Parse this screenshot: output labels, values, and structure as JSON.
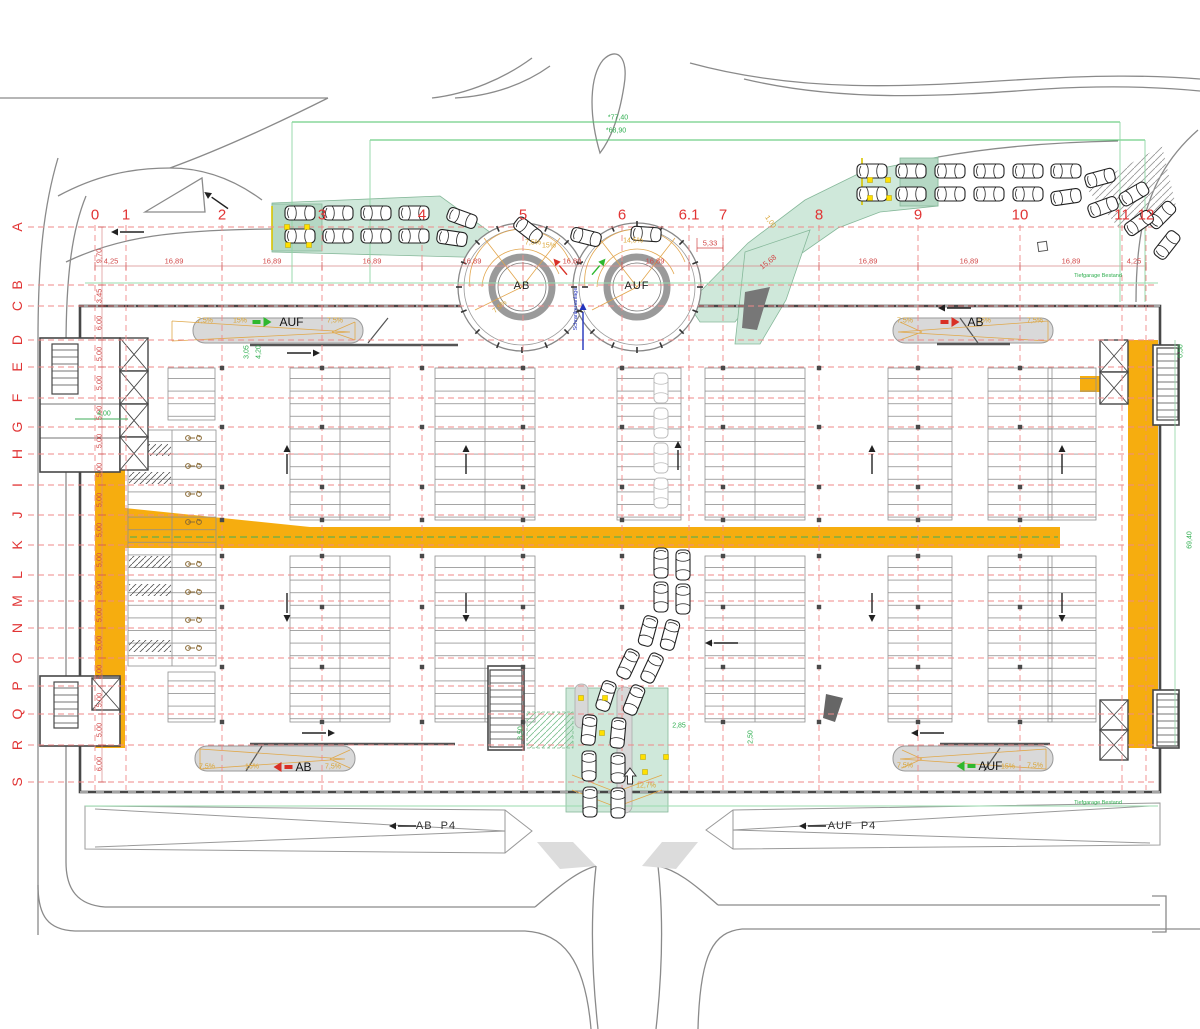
{
  "drawing": {
    "type": "parking-garage-floor-plan",
    "circle_ramp_left": "AB",
    "circle_ramp_right": "AUF"
  },
  "colors": {
    "grid_red": "#e13535",
    "dim_green": "#2fae4f",
    "lane_orange": "#F6AD0F",
    "ramp_green_fill": "#cfe8da",
    "slope_orange": "#d9a434",
    "note_blue": "#2233bb"
  },
  "grid": {
    "columns": [
      [
        "0",
        95
      ],
      [
        "1",
        126
      ],
      [
        "2",
        222
      ],
      [
        "3",
        322
      ],
      [
        "4",
        422
      ],
      [
        "5",
        523
      ],
      [
        "6",
        622
      ],
      [
        "6.1",
        689
      ],
      [
        "7",
        723
      ],
      [
        "8",
        819
      ],
      [
        "9",
        918
      ],
      [
        "10",
        1020
      ],
      [
        "11",
        1122
      ],
      [
        "12",
        1146
      ]
    ],
    "rows": [
      [
        "A",
        227
      ],
      [
        "B",
        285
      ],
      [
        "C",
        306
      ],
      [
        "D",
        340
      ],
      [
        "E",
        367
      ],
      [
        "F",
        398
      ],
      [
        "G",
        427
      ],
      [
        "H",
        454
      ],
      [
        "I",
        485
      ],
      [
        "J",
        515
      ],
      [
        "K",
        545
      ],
      [
        "L",
        575
      ],
      [
        "M",
        601
      ],
      [
        "N",
        628
      ],
      [
        "O",
        658
      ],
      [
        "P",
        686
      ],
      [
        "Q",
        714
      ],
      [
        "R",
        745
      ],
      [
        "S",
        782
      ]
    ],
    "row_dims": [
      "9,70",
      "3,45",
      "6,00",
      "5,00",
      "5,00",
      "5,00",
      "5,00",
      "5,00",
      "5,00",
      "5,00",
      "5,00",
      "3,90",
      "5,00",
      "5,00",
      "5,00",
      "5,00",
      "5,00",
      "6,00"
    ]
  },
  "texts": [
    [
      "*77,40",
      618,
      118,
      "dg",
      0
    ],
    [
      "*68,90",
      616,
      131,
      "dg",
      0
    ],
    [
      "4,25",
      111,
      261,
      "dr",
      0
    ],
    [
      "16,89",
      174,
      261,
      "dr",
      0
    ],
    [
      "16,89",
      272,
      261,
      "dr",
      0
    ],
    [
      "16,89",
      372,
      261,
      "dr",
      0
    ],
    [
      "16,89",
      472,
      261,
      "dr",
      0
    ],
    [
      "16,89",
      572,
      261,
      "dr",
      0
    ],
    [
      "16,89",
      655,
      261,
      "dr",
      0
    ],
    [
      "5,33",
      710,
      243,
      "dr",
      0
    ],
    [
      "15,68",
      768,
      262,
      "dr",
      -38
    ],
    [
      "16,89",
      868,
      261,
      "dr",
      0
    ],
    [
      "16,89",
      969,
      261,
      "dr",
      0
    ],
    [
      "16,89",
      1071,
      261,
      "dr",
      0
    ],
    [
      "4,25",
      1134,
      261,
      "dr",
      0
    ],
    [
      "4,00",
      104,
      414,
      "dg",
      0
    ],
    [
      "3,05",
      247,
      352,
      "dg",
      -90
    ],
    [
      "4,20",
      259,
      352,
      "dg",
      -90
    ],
    [
      "0,50",
      1181,
      351,
      "dg",
      -90
    ],
    [
      "69,40",
      1190,
      540,
      "dg",
      -90
    ],
    [
      "2,85",
      679,
      726,
      "dg",
      0
    ],
    [
      "2,50",
      751,
      737,
      "dg",
      -90
    ],
    [
      "3,50",
      521,
      733,
      "dg",
      -90
    ],
    [
      "7,5%",
      205,
      321,
      "pc",
      0
    ],
    [
      "15%",
      240,
      321,
      "pc",
      0
    ],
    [
      "7,5%",
      335,
      321,
      "pc",
      0
    ],
    [
      "7,5%",
      905,
      321,
      "pc",
      0
    ],
    [
      "15%",
      984,
      321,
      "pc",
      0
    ],
    [
      "7,5%",
      1035,
      321,
      "pc",
      0
    ],
    [
      "7,5%",
      207,
      767,
      "pc",
      0
    ],
    [
      "15%",
      252,
      767,
      "pc",
      0
    ],
    [
      "7,5%",
      333,
      767,
      "pc",
      0
    ],
    [
      "7,5%",
      905,
      766,
      "pc",
      0
    ],
    [
      "15%",
      1008,
      767,
      "pc",
      0
    ],
    [
      "7,5%",
      1035,
      766,
      "pc",
      0
    ],
    [
      "14,5%",
      633,
      241,
      "pc",
      0
    ],
    [
      "15%",
      549,
      246,
      "pc",
      0
    ],
    [
      "7,5%",
      533,
      243,
      "pc",
      0
    ],
    [
      "7,5%",
      500,
      307,
      "pc",
      -40
    ],
    [
      "12,7%",
      646,
      786,
      "pc",
      0
    ],
    [
      "1,00",
      770,
      222,
      "pc",
      55
    ],
    [
      "AB",
      522,
      286,
      "cl",
      0
    ],
    [
      "AUF",
      637,
      286,
      "cl",
      0
    ],
    [
      "AB  P4",
      436,
      826,
      "pl",
      0
    ],
    [
      "AUF  P4",
      852,
      826,
      "pl",
      0
    ],
    [
      "Tiefgarage Bestand",
      1098,
      276,
      "nt",
      0
    ],
    [
      "Tiefgarage Bestand",
      1098,
      803,
      "nt",
      0
    ],
    [
      "Schrankenanlage",
      576,
      309,
      "bl",
      -90
    ]
  ],
  "ramp_labels": [
    [
      "AUF",
      278,
      322,
      "right",
      "#2eb82e"
    ],
    [
      "AB",
      962,
      322,
      "right",
      "#d93025"
    ],
    [
      "AB",
      290,
      767,
      "left",
      "#d93025"
    ],
    [
      "AUF",
      977,
      766,
      "left",
      "#2eb82e"
    ]
  ],
  "parking_banks": [
    [
      168,
      368,
      47,
      52
    ],
    [
      290,
      368,
      100,
      152
    ],
    [
      435,
      368,
      100,
      152
    ],
    [
      617,
      368,
      64,
      152
    ],
    [
      705,
      368,
      100,
      152
    ],
    [
      888,
      368,
      64,
      152
    ],
    [
      988,
      368,
      64,
      152
    ],
    [
      1048,
      368,
      48,
      152
    ],
    [
      290,
      556,
      100,
      166
    ],
    [
      435,
      556,
      100,
      166
    ],
    [
      705,
      556,
      100,
      166
    ],
    [
      888,
      556,
      64,
      166
    ],
    [
      988,
      556,
      64,
      166
    ],
    [
      1048,
      556,
      48,
      166
    ],
    [
      168,
      672,
      47,
      50
    ]
  ],
  "moto_bay": {
    "x": 128,
    "y": 430,
    "w": 88,
    "h": 236,
    "hatch_cells": [
      [
        129,
        444
      ],
      [
        129,
        472
      ],
      [
        129,
        556
      ],
      [
        129,
        584
      ],
      [
        129,
        640
      ]
    ],
    "scooters": [
      [
        193,
        438
      ],
      [
        193,
        466
      ],
      [
        193,
        494
      ],
      [
        193,
        522
      ],
      [
        193,
        564
      ],
      [
        193,
        592
      ],
      [
        193,
        620
      ],
      [
        193,
        648
      ]
    ]
  },
  "vehicles": [
    [
      300,
      213,
      0,
      0
    ],
    [
      338,
      213,
      0,
      0
    ],
    [
      376,
      213,
      0,
      0
    ],
    [
      414,
      213,
      0,
      0
    ],
    [
      462,
      218,
      20,
      0
    ],
    [
      300,
      236,
      0,
      0
    ],
    [
      338,
      236,
      0,
      0
    ],
    [
      376,
      236,
      0,
      0
    ],
    [
      414,
      236,
      0,
      0
    ],
    [
      452,
      238,
      8,
      0
    ],
    [
      528,
      230,
      38,
      0
    ],
    [
      586,
      237,
      14,
      0
    ],
    [
      646,
      234,
      4,
      0
    ],
    [
      872,
      171,
      0,
      0
    ],
    [
      911,
      171,
      0,
      0
    ],
    [
      950,
      171,
      0,
      0
    ],
    [
      989,
      171,
      0,
      0
    ],
    [
      1028,
      171,
      0,
      0
    ],
    [
      1066,
      171,
      0,
      0
    ],
    [
      1100,
      178,
      -15,
      0
    ],
    [
      1134,
      194,
      -30,
      0
    ],
    [
      1162,
      215,
      -45,
      0
    ],
    [
      872,
      194,
      0,
      0
    ],
    [
      911,
      194,
      0,
      0
    ],
    [
      950,
      194,
      0,
      0
    ],
    [
      989,
      194,
      0,
      0
    ],
    [
      1028,
      194,
      0,
      0
    ],
    [
      1066,
      197,
      -8,
      0
    ],
    [
      1103,
      207,
      -20,
      0
    ],
    [
      1139,
      223,
      -35,
      0
    ],
    [
      1167,
      245,
      -52,
      0
    ],
    [
      661,
      388,
      90,
      1
    ],
    [
      661,
      423,
      90,
      1
    ],
    [
      661,
      458,
      90,
      1
    ],
    [
      661,
      493,
      90,
      1
    ],
    [
      661,
      563,
      90,
      0
    ],
    [
      683,
      565,
      90,
      0
    ],
    [
      661,
      597,
      90,
      0
    ],
    [
      683,
      599,
      90,
      0
    ],
    [
      648,
      631,
      105,
      0
    ],
    [
      670,
      635,
      105,
      0
    ],
    [
      628,
      664,
      115,
      0
    ],
    [
      652,
      668,
      115,
      0
    ],
    [
      606,
      696,
      108,
      0
    ],
    [
      634,
      700,
      112,
      0
    ],
    [
      589,
      730,
      95,
      0
    ],
    [
      618,
      733,
      95,
      0
    ],
    [
      589,
      766,
      90,
      0
    ],
    [
      618,
      768,
      90,
      0
    ],
    [
      590,
      802,
      90,
      0
    ],
    [
      618,
      803,
      90,
      0
    ]
  ],
  "arrows": [
    [
      118,
      232,
      180,
      26,
      "k"
    ],
    [
      210,
      196,
      215,
      22,
      "k"
    ],
    [
      313,
      353,
      0,
      26,
      "k"
    ],
    [
      945,
      308,
      180,
      26,
      "k"
    ],
    [
      287,
      452,
      270,
      22,
      "k"
    ],
    [
      466,
      452,
      270,
      22,
      "k"
    ],
    [
      678,
      448,
      270,
      22,
      "k"
    ],
    [
      872,
      452,
      270,
      22,
      "k"
    ],
    [
      1062,
      452,
      270,
      22,
      "k"
    ],
    [
      287,
      615,
      90,
      22,
      "k"
    ],
    [
      466,
      615,
      90,
      22,
      "k"
    ],
    [
      872,
      615,
      90,
      22,
      "k"
    ],
    [
      1062,
      615,
      90,
      22,
      "k"
    ],
    [
      328,
      733,
      0,
      26,
      "k"
    ],
    [
      918,
      733,
      180,
      26,
      "k"
    ],
    [
      712,
      643,
      180,
      26,
      "k"
    ],
    [
      396,
      826,
      180,
      20,
      "k"
    ],
    [
      806,
      826,
      180,
      20,
      "k"
    ],
    [
      630,
      776,
      270,
      16,
      "o"
    ],
    [
      558,
      264,
      230,
      14,
      "r"
    ],
    [
      601,
      264,
      310,
      14,
      "g"
    ],
    [
      583,
      310,
      270,
      40,
      "b"
    ]
  ],
  "sensors": [
    [
      287,
      227
    ],
    [
      307,
      227
    ],
    [
      288,
      245
    ],
    [
      309,
      245
    ],
    [
      870,
      180
    ],
    [
      888,
      180
    ],
    [
      870,
      198
    ],
    [
      889,
      198
    ],
    [
      581,
      698
    ],
    [
      605,
      698
    ],
    [
      643,
      757
    ],
    [
      666,
      757
    ],
    [
      645,
      772
    ],
    [
      602,
      733
    ]
  ],
  "xboxes": [
    [
      120,
      338,
      28,
      33
    ],
    [
      120,
      371,
      28,
      33
    ],
    [
      120,
      404,
      28,
      33
    ],
    [
      120,
      437,
      28,
      33
    ],
    [
      1100,
      340,
      28,
      32
    ],
    [
      1100,
      372,
      28,
      32
    ],
    [
      1100,
      700,
      28,
      30
    ],
    [
      1100,
      730,
      28,
      30
    ],
    [
      92,
      678,
      28,
      32
    ]
  ],
  "stairs": [
    [
      52,
      344,
      26,
      50
    ],
    [
      1157,
      348,
      21,
      72
    ],
    [
      1157,
      694,
      21,
      52
    ],
    [
      54,
      682,
      24,
      46
    ],
    [
      490,
      670,
      32,
      77
    ]
  ],
  "circles": [
    [
      522,
      287
    ],
    [
      637,
      287
    ]
  ]
}
